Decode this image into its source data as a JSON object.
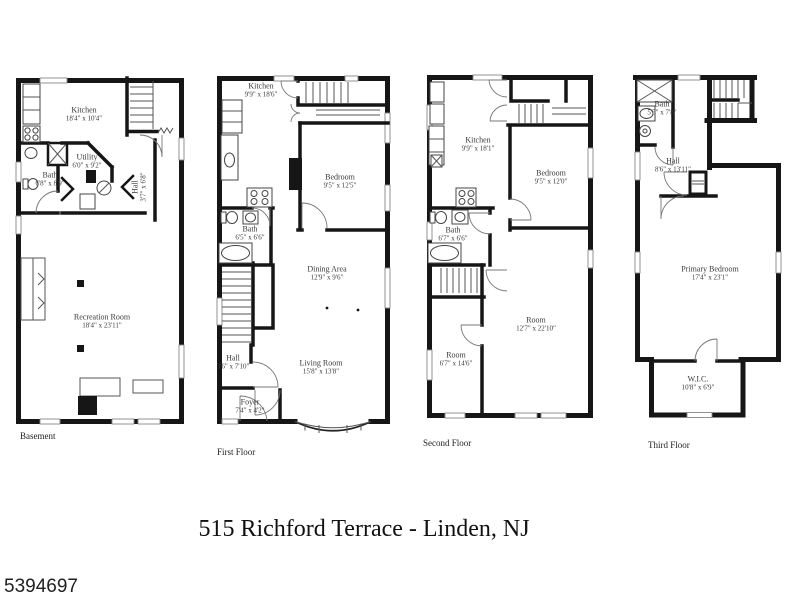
{
  "title": "515 Richford Terrace - Linden, NJ",
  "listing_number": "5394697",
  "colors": {
    "wall": "#161616",
    "text": "#3a3a3a",
    "background": "#ffffff"
  },
  "floors": {
    "basement": {
      "label": "Basement",
      "rooms": {
        "kitchen": {
          "name": "Kitchen",
          "dims": "18'4\" x 10'4\""
        },
        "utility": {
          "name": "Utility",
          "dims": "6'0\" x 9'2\""
        },
        "bath": {
          "name": "Bath",
          "dims": "6'8\" x 8'9\""
        },
        "hall": {
          "name": "Hall",
          "dims": "3'7\" x 6'8\""
        },
        "recreation": {
          "name": "Recreation Room",
          "dims": "18'4\" x 23'11\""
        }
      }
    },
    "first": {
      "label": "First Floor",
      "rooms": {
        "kitchen": {
          "name": "Kitchen",
          "dims": "9'9\" x 18'6\""
        },
        "bedroom": {
          "name": "Bedroom",
          "dims": "9'5\" x 12'5\""
        },
        "bath": {
          "name": "Bath",
          "dims": "6'5\" x 6'6\""
        },
        "dining": {
          "name": "Dining Area",
          "dims": "12'9\" x 9'6\""
        },
        "living": {
          "name": "Living Room",
          "dims": "15'8\" x 13'8\""
        },
        "hall": {
          "name": "Hall",
          "dims": "3'6\" x 7'10\""
        },
        "foyer": {
          "name": "Foyer",
          "dims": "7'4\" x 4'2\""
        }
      }
    },
    "second": {
      "label": "Second Floor",
      "rooms": {
        "kitchen": {
          "name": "Kitchen",
          "dims": "9'9\" x 18'1\""
        },
        "bedroom": {
          "name": "Bedroom",
          "dims": "9'5\" x 12'0\""
        },
        "bath": {
          "name": "Bath",
          "dims": "6'7\" x 6'6\""
        },
        "room_large": {
          "name": "Room",
          "dims": "12'7\" x 22'10\""
        },
        "room_small": {
          "name": "Room",
          "dims": "6'7\" x 14'6\""
        }
      }
    },
    "third": {
      "label": "Third Floor",
      "rooms": {
        "bath": {
          "name": "Bath",
          "dims": "5'5\" x 7'8\""
        },
        "hall": {
          "name": "Hall",
          "dims": "8'6\" x 13'11\""
        },
        "primary": {
          "name": "Primary Bedroom",
          "dims": "17'4\" x 23'1\""
        },
        "wic": {
          "name": "W.I.C.",
          "dims": "10'8\" x 6'9\""
        }
      }
    }
  }
}
